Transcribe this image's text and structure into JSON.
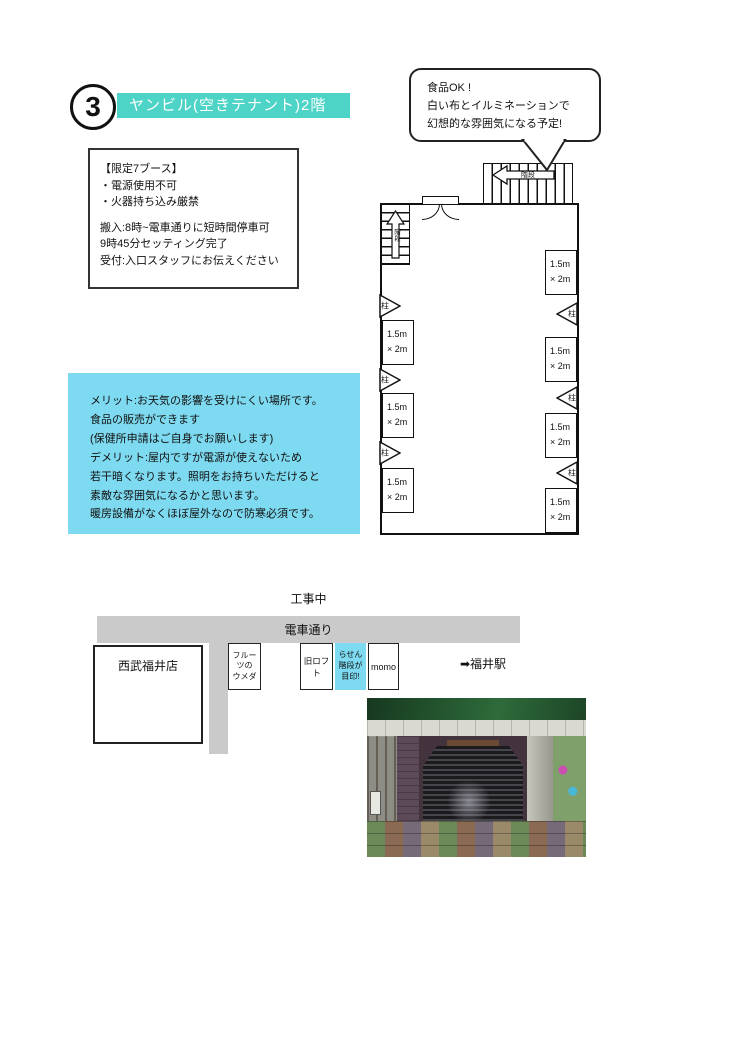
{
  "header": {
    "number": "3",
    "title": "ヤンビル(空きテナント)2階"
  },
  "speech_bubble": {
    "lines": [
      "食品OK !",
      "白い布とイルミネーションで",
      "幻想的な雰囲気になる予定!"
    ]
  },
  "info_box": {
    "rules": [
      "【限定7ブース】",
      "・電源使用不可",
      "・火器持ち込み厳禁"
    ],
    "logistics": [
      "搬入:8時~電車通りに短時間停車可",
      "   9時45分セッティング完了",
      "受付:入口スタッフにお伝えください"
    ]
  },
  "merit_box": {
    "lines": [
      "メリット:お天気の影響を受けにくい場所です。",
      "    食品の販売ができます",
      "    (保健所申請はご自身でお願いします)",
      "デメリット:屋内ですが電源が使えないため",
      "     若干暗くなります。照明をお持ちいただけると",
      "     素敵な雰囲気になるかと思います。",
      "     暖房設備がなくほぼ屋外なので防寒必須です。"
    ]
  },
  "floor_plan": {
    "booth_line1": "1.5m",
    "booth_line2": "× 2m",
    "pillar_label": "柱",
    "top_stairs_label": "階段",
    "left_stairs_label": "階段",
    "booth_count": 7
  },
  "map": {
    "construction_label": "工事中",
    "street_label": "電車通り",
    "seibu": "西武福井店",
    "fruits_line1": "フルーツの",
    "fruits_line2": "ウメダ",
    "loft": "旧ロフト",
    "rasen_line1": "らせん",
    "rasen_line2": "階段が",
    "rasen_line3": "目印!",
    "momo": "momo",
    "station": "➡福井駅"
  },
  "colors": {
    "accent_teal": "#4ed3c7",
    "light_cyan": "#7edaf0",
    "street_gray": "#cacaca"
  }
}
